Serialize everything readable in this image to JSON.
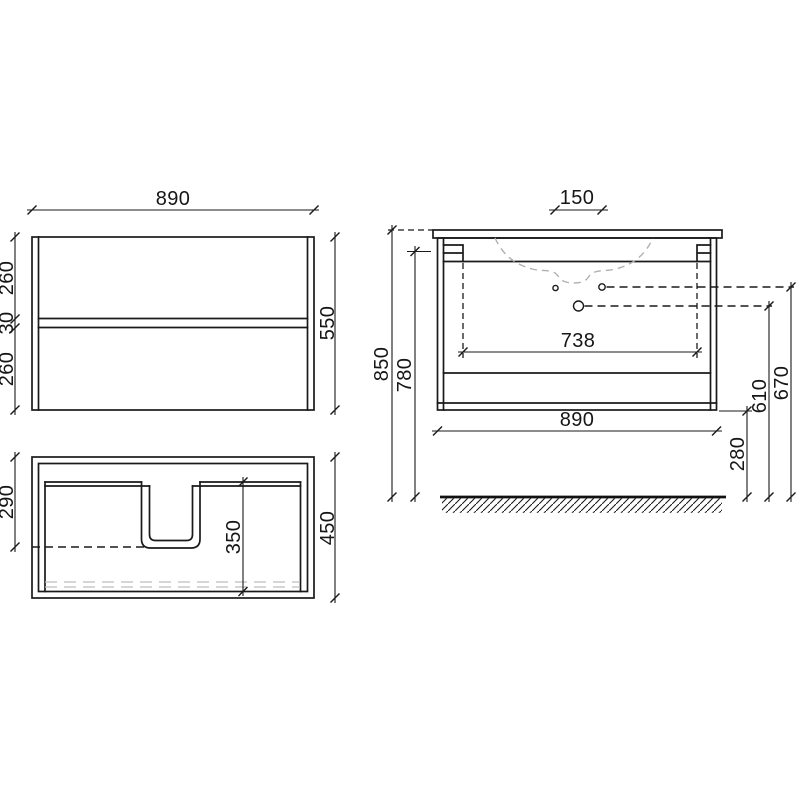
{
  "palette": {
    "line_color": "#1a1a1a",
    "hidden_detail_color": "#b0b0b0"
  },
  "views": {
    "front": {
      "width": "890",
      "height": "550",
      "upper_drawer_height": "260",
      "drawer_gap": "30",
      "lower_drawer_height": "260"
    },
    "plan": {
      "siphon_cutout_depth": "290",
      "inner_depth": "350",
      "overall_depth": "450"
    },
    "side": {
      "faucet_hole_spacing": "150",
      "overall_height": "850",
      "hanger_height": "780",
      "hanger_spacing": "738",
      "overall_width": "890",
      "floor_clearance": "280",
      "drain_hole_height": "610",
      "faucet_hole_height": "670"
    }
  }
}
